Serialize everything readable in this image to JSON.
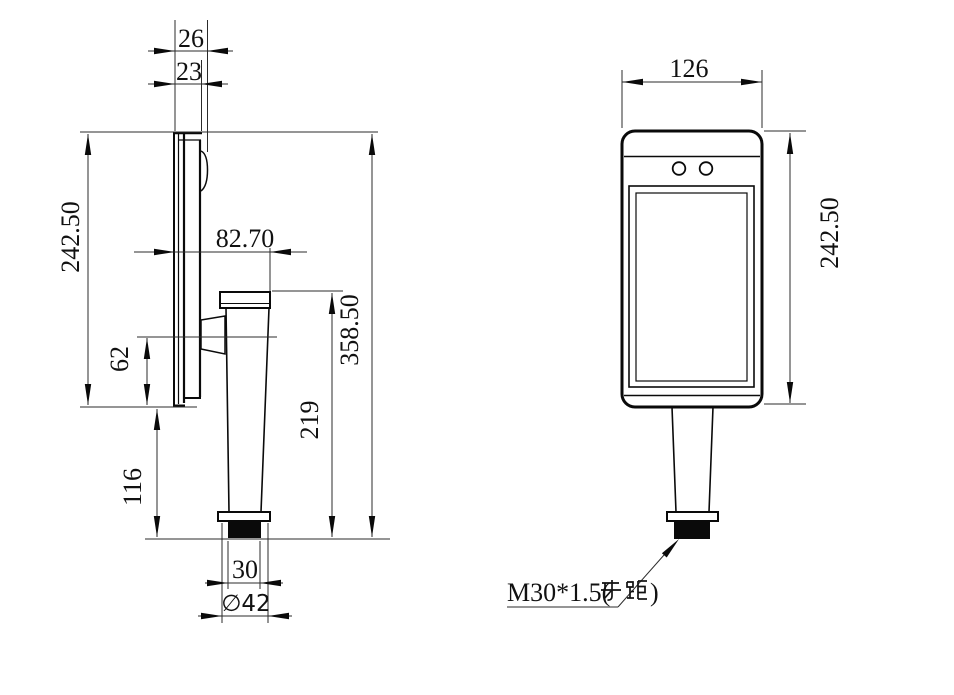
{
  "colors": {
    "background": "#ffffff",
    "lines": "#000000",
    "thread_fill": "#000000"
  },
  "side_view": {
    "dimensions": {
      "depth_total": "26",
      "depth_body": "23",
      "device_height": "242.50",
      "mount_offset": "82.70",
      "bracket_height": "62",
      "lower_clearance": "116",
      "pole_height": "219",
      "overall_height": "358.50",
      "thread_width": "30",
      "flange_diameter": "∅42"
    }
  },
  "front_view": {
    "dimensions": {
      "device_width": "126",
      "device_height": "242.50"
    },
    "thread_label": "M30*1.5(牙距)",
    "thread_label_prefix": "M30*1.5(",
    "thread_label_suffix": ")"
  }
}
